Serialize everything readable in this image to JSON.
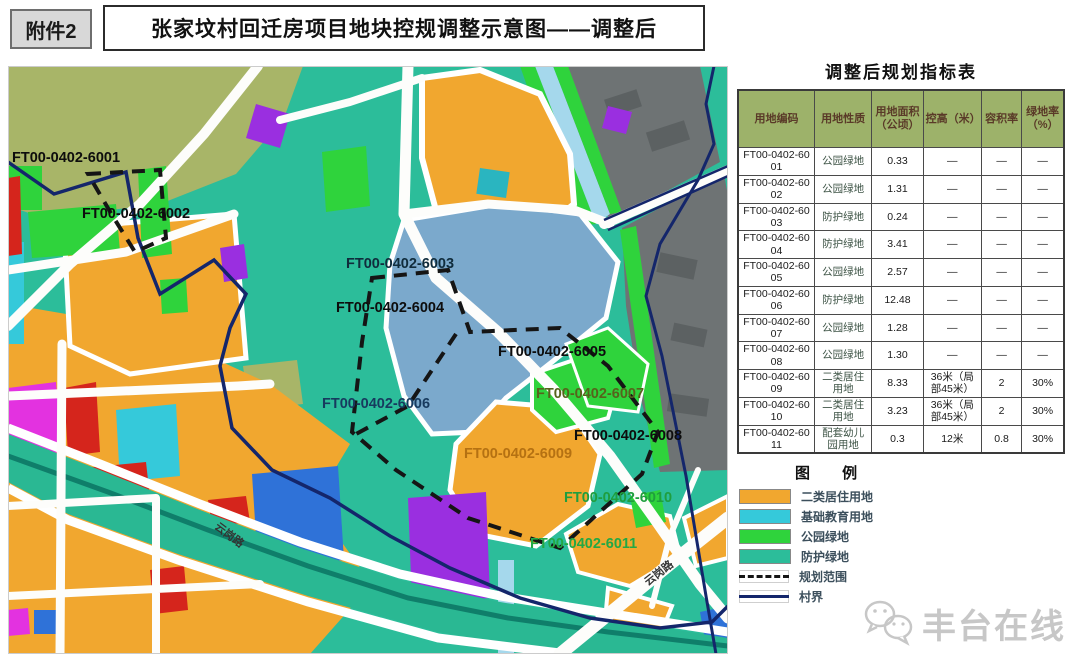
{
  "page": {
    "attachment_badge": "附件2",
    "title": "张家坟村回迁房项目地块控规调整示意图——调整后"
  },
  "map": {
    "plot_labels": [
      {
        "id": "FT00-0402-6001",
        "x": 4,
        "y": 96,
        "color": "#0d0d0d"
      },
      {
        "id": "FT00-0402-6002",
        "x": 74,
        "y": 152,
        "color": "#0d0d0d"
      },
      {
        "id": "FT00-0402-6003",
        "x": 338,
        "y": 202,
        "color": "#102c3c"
      },
      {
        "id": "FT00-0402-6004",
        "x": 328,
        "y": 246,
        "color": "#0d0d0d"
      },
      {
        "id": "FT00-0402-6005",
        "x": 490,
        "y": 290,
        "color": "#0d0d0d"
      },
      {
        "id": "FT00-0402-6006",
        "x": 314,
        "y": 342,
        "color": "#173a5e"
      },
      {
        "id": "FT00-0402-6007",
        "x": 528,
        "y": 332,
        "color": "#56631c"
      },
      {
        "id": "FT00-0402-6008",
        "x": 566,
        "y": 374,
        "color": "#0d0d0d"
      },
      {
        "id": "FT00-0402-6009",
        "x": 456,
        "y": 392,
        "color": "#b57112"
      },
      {
        "id": "FT00-0402-6010",
        "x": 556,
        "y": 436,
        "color": "#1f9e3e"
      },
      {
        "id": "FT00-0402-6011",
        "x": 522,
        "y": 482,
        "color": "#23a844"
      }
    ],
    "road_labels": [
      {
        "text": "云岗路",
        "x": 206,
        "y": 462,
        "rotate": 37
      },
      {
        "text": "云岗路",
        "x": 640,
        "y": 520,
        "rotate": -38
      }
    ]
  },
  "table": {
    "title": "调整后规划指标表",
    "headers": [
      "用地编码",
      "用地性质",
      "用地面积（公顷）",
      "控高（米）",
      "容积率",
      "绿地率（%）"
    ],
    "rows": [
      [
        "FT00-0402-6001",
        "公园绿地",
        "0.33",
        "—",
        "—",
        "—"
      ],
      [
        "FT00-0402-6002",
        "公园绿地",
        "1.31",
        "—",
        "—",
        "—"
      ],
      [
        "FT00-0402-6003",
        "防护绿地",
        "0.24",
        "—",
        "—",
        "—"
      ],
      [
        "FT00-0402-6004",
        "防护绿地",
        "3.41",
        "—",
        "—",
        "—"
      ],
      [
        "FT00-0402-6005",
        "公园绿地",
        "2.57",
        "—",
        "—",
        "—"
      ],
      [
        "FT00-0402-6006",
        "防护绿地",
        "12.48",
        "—",
        "—",
        "—"
      ],
      [
        "FT00-0402-6007",
        "公园绿地",
        "1.28",
        "—",
        "—",
        "—"
      ],
      [
        "FT00-0402-6008",
        "公园绿地",
        "1.30",
        "—",
        "—",
        "—"
      ],
      [
        "FT00-0402-6009",
        "二类居住用地",
        "8.33",
        "36米（局部45米）",
        "2",
        "30%"
      ],
      [
        "FT00-0402-6010",
        "二类居住用地",
        "3.23",
        "36米（局部45米）",
        "2",
        "30%"
      ],
      [
        "FT00-0402-6011",
        "配套幼儿园用地",
        "0.3",
        "12米",
        "0.8",
        "30%"
      ]
    ]
  },
  "legend": {
    "title": "图  例",
    "items": [
      {
        "label": "二类居住用地",
        "swatch": "fill",
        "color": "#f1a72f"
      },
      {
        "label": "基础教育用地",
        "swatch": "fill",
        "color": "#35c9da"
      },
      {
        "label": "公园绿地",
        "swatch": "fill",
        "color": "#2fd33c"
      },
      {
        "label": "防护绿地",
        "swatch": "fill",
        "color": "#2cbd9a"
      },
      {
        "label": "规划范围",
        "swatch": "dashed",
        "color": "#151515"
      },
      {
        "label": "村界",
        "swatch": "line",
        "color": "#14266b"
      }
    ]
  },
  "watermark": {
    "text": "丰台在线"
  },
  "colors": {
    "residential_orange": "#f1a72f",
    "education_cyan": "#35c9da",
    "park_green": "#2fd33c",
    "protective_teal": "#2cbd9a",
    "village_boundary_navy": "#14266b",
    "planning_boundary_black": "#151515",
    "table_header_green": "#9db26a"
  }
}
